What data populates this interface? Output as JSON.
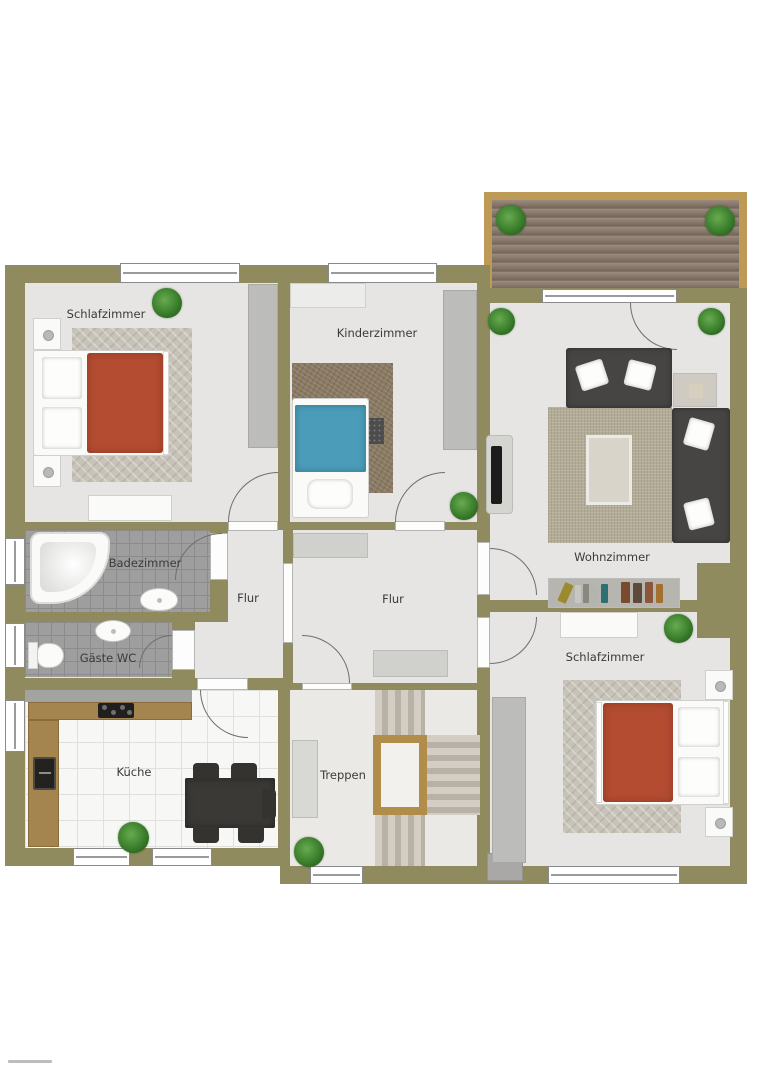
{
  "title": "Grundriss / floor plan",
  "rooms": {
    "schlafzimmer1": "Schlafzimmer",
    "kinderzimmer": "Kinderzimmer",
    "wohnzimmer": "Wohnzimmer",
    "badezimmer": "Badezimmer",
    "gaeste_wc": "Gäste WC",
    "flur_west": "Flur",
    "flur_mitte": "Flur",
    "kueche": "Küche",
    "treppen": "Treppen",
    "schlafzimmer2": "Schlafzimmer"
  },
  "colors": {
    "wall": "#8f8b5e",
    "floor": "#e6e5e3",
    "bath_tile": "#9e9e9e",
    "kitchen_tile": "#f7f7f5",
    "deck_frame": "#bd9b57",
    "deck_wood": "#8d7e71",
    "bed_red": "#b34c31",
    "bed_blue": "#4a9cb8",
    "sofa_dark": "#474544",
    "rug_beige": "#b3ac97",
    "rug_gray": "#c8c3b8",
    "rug_brown": "#8a7963",
    "counter_wood": "#a5854f",
    "table_dark": "#3b3936",
    "plant_green": "#3a7d2b"
  }
}
